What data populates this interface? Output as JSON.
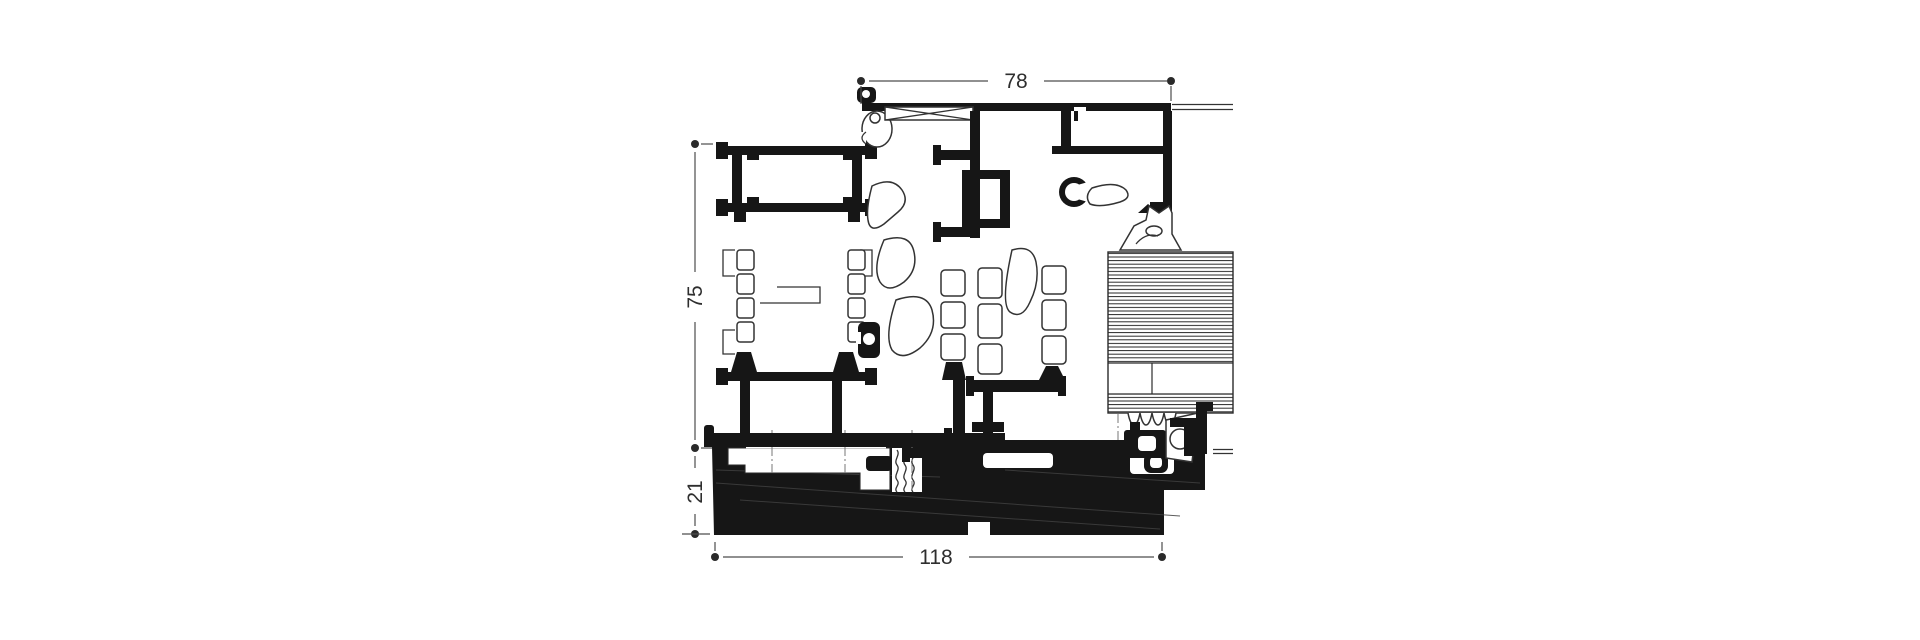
{
  "page": {
    "background": "#ffffff"
  },
  "drawing": {
    "type": "window-sill-profile-cross-section",
    "profile_fill_color": "#161616",
    "dimension_line_color": "#4d4d4d",
    "dimensions": {
      "top_width": "78",
      "frame_height": "75",
      "sill_height": "21",
      "total_depth": "118"
    }
  }
}
